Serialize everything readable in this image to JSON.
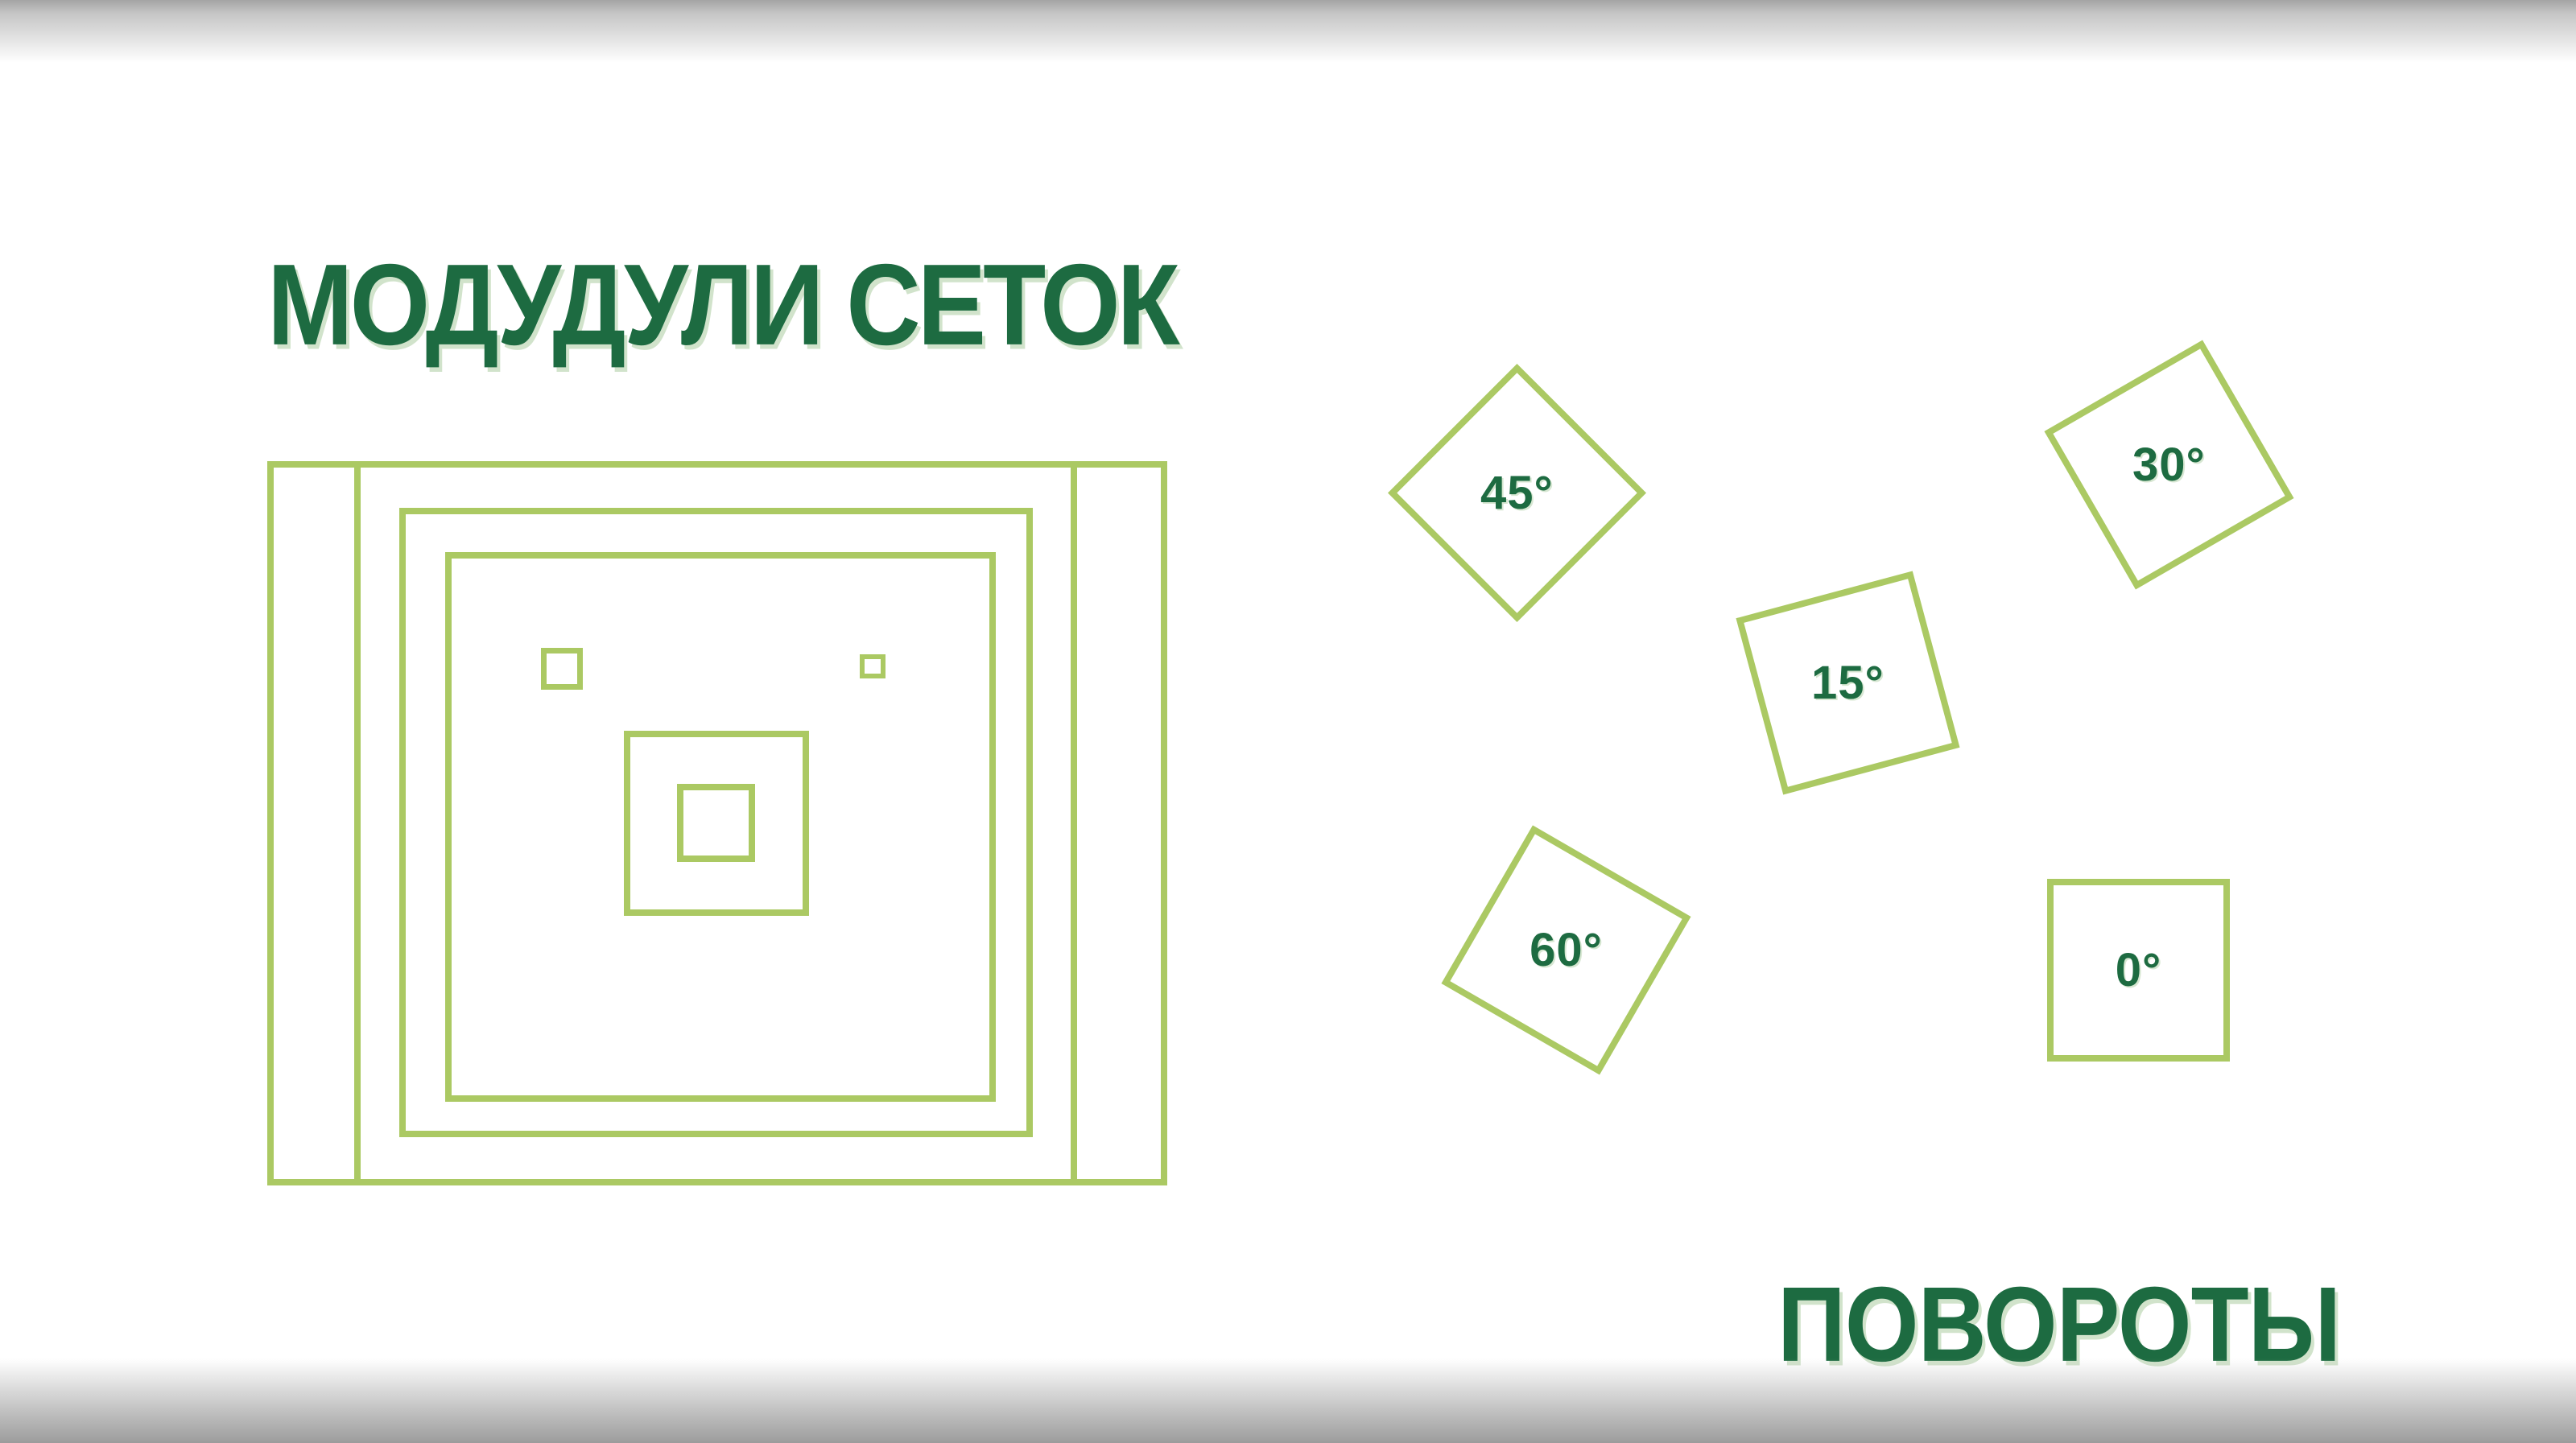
{
  "slide": {
    "colors": {
      "outline_green": "#abc963",
      "text_green": "#1d6b41",
      "edge_gray_top": "#a4a4a4",
      "edge_gray_bottom": "#9c9c9c"
    },
    "grids": {
      "title": "МОДУДУЛИ СЕТОК"
    },
    "rotations": {
      "title": "ПОВОРОТЫ",
      "squares": [
        {
          "label": "45°",
          "angle_deg": 45
        },
        {
          "label": "30°",
          "angle_deg": 30
        },
        {
          "label": "15°",
          "angle_deg": 15
        },
        {
          "label": "60°",
          "angle_deg": 60
        },
        {
          "label": "0°",
          "angle_deg": 0
        }
      ]
    }
  }
}
